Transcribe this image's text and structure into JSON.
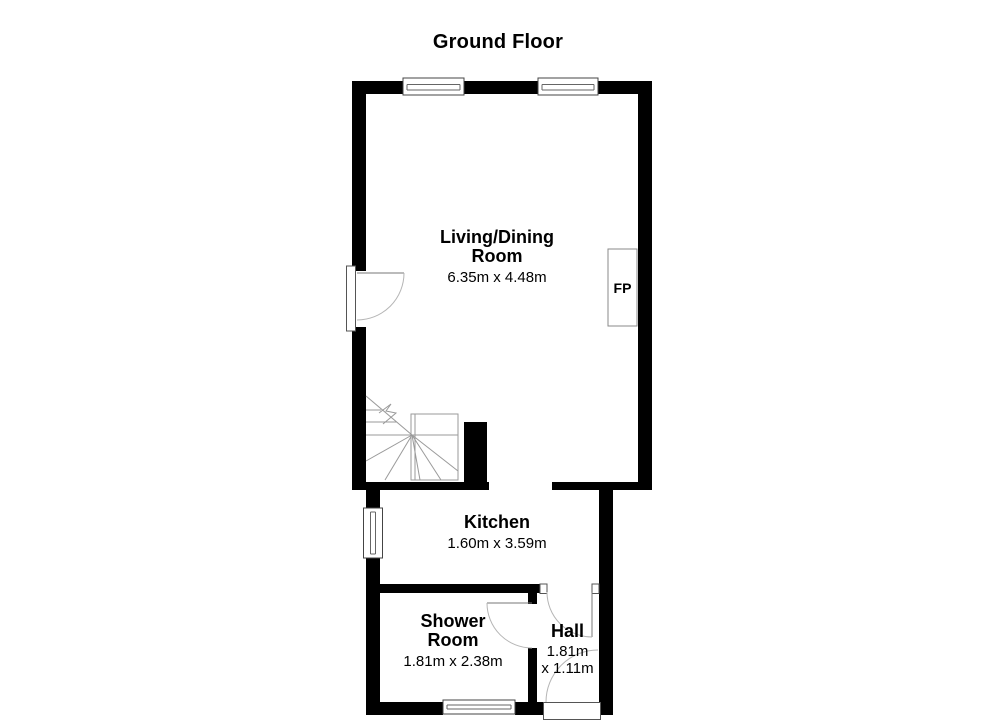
{
  "title": "Ground Floor",
  "rooms": {
    "living_dining": {
      "name_line1": "Living/Dining",
      "name_line2": "Room",
      "dimensions": "6.35m x 4.48m"
    },
    "kitchen": {
      "name": "Kitchen",
      "dimensions": "1.60m x 3.59m"
    },
    "shower_room": {
      "name_line1": "Shower",
      "name_line2": "Room",
      "dimensions": "1.81m x 2.38m"
    },
    "hall": {
      "name": "Hall",
      "dimensions_line1": "1.81m",
      "dimensions_line2": "x 1.11m"
    }
  },
  "fireplace": {
    "label": "FP"
  },
  "colors": {
    "wall": "#000000",
    "background": "#ffffff",
    "text": "#000000",
    "symbol_line": "#9a9a9a",
    "door_arc": "#b5b5b5",
    "window_frame": "#444444"
  }
}
